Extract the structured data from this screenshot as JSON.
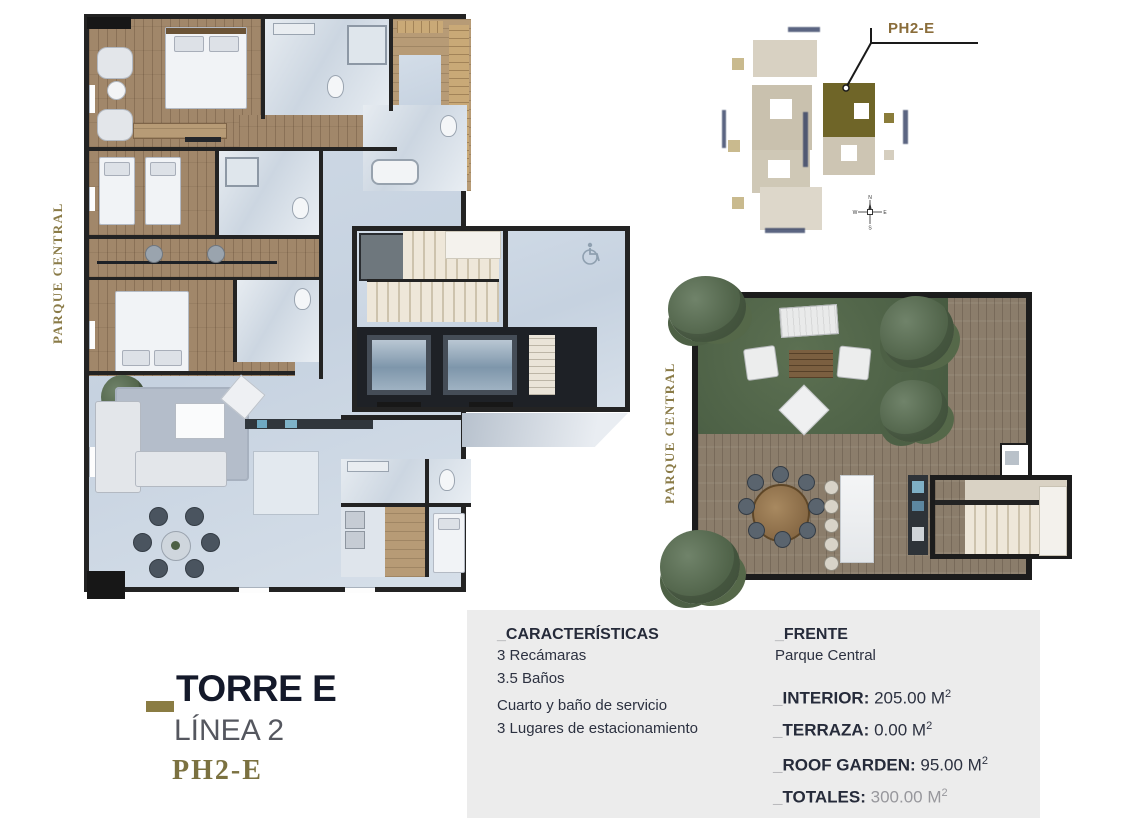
{
  "plan_labels": {
    "park_left": "PARQUE CENTRAL",
    "park_roof": "PARQUE CENTRAL"
  },
  "site_map": {
    "unit_label": "PH2-E",
    "compass": {
      "n": "N",
      "e": "E",
      "s": "S",
      "w": "W"
    }
  },
  "brand": {
    "tower": "TORRE E",
    "line": "LÍNEA 2",
    "unit": "PH2-E"
  },
  "panel": {
    "caracteristicas": {
      "prefix": "_",
      "title": "CARACTERÍSTICAS",
      "items": [
        "3 Recámaras",
        "3.5 Baños",
        "Cuarto y baño de servicio",
        "3 Lugares de estacionamiento"
      ]
    },
    "frente": {
      "prefix": "_",
      "title": "FRENTE",
      "value": "Parque Central"
    },
    "areas": [
      {
        "prefix": "_",
        "label": "INTERIOR:",
        "value": "205.00 M",
        "sup": "2"
      },
      {
        "prefix": "_",
        "label": "TERRAZA:",
        "value": "0.00 M",
        "sup": "2"
      },
      {
        "prefix": "_",
        "label": "ROOF GARDEN:",
        "value": "95.00 M",
        "sup": "2"
      },
      {
        "prefix": "_",
        "label": "TOTALES:",
        "value": "300.00 M",
        "sup": "2"
      }
    ]
  },
  "colors": {
    "accent_olive": "#8a7c43",
    "navy": "#14192a",
    "site_highlight": "#6f6528",
    "grass": "#4d6146",
    "deck": "#8b7d6b",
    "panel_bg": "#ececec"
  }
}
